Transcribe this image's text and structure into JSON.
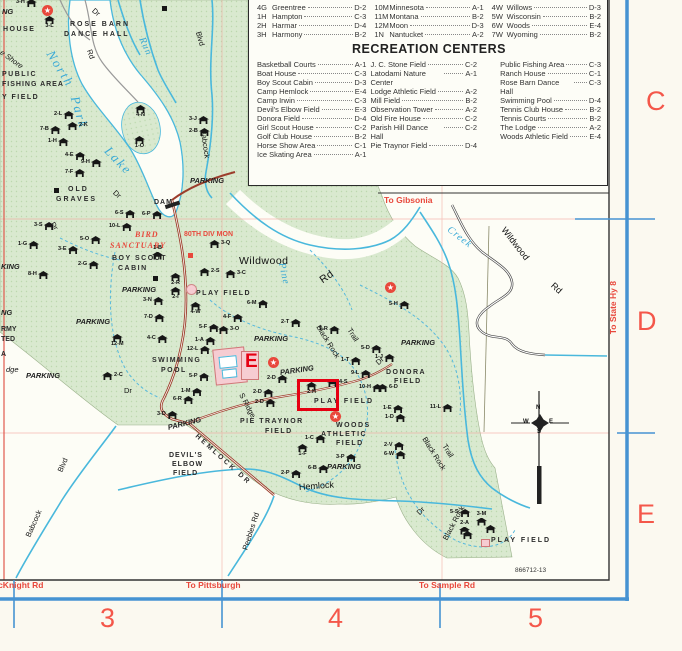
{
  "colors": {
    "park_green": "#d9e9cf",
    "water_blue": "#49b8dc",
    "map_red": "#e8483c",
    "neatline_blue": "#4693d2",
    "road_red": "#9c3d2c",
    "highlight_red": "#e60012"
  },
  "legend_index": {
    "columns": [
      {
        "entries": [
          {
            "code": "4G",
            "name": "Greentree",
            "grid": "D-2"
          },
          {
            "code": "1H",
            "name": "Hampton",
            "grid": "C-3"
          },
          {
            "code": "2H",
            "name": "Harmar",
            "grid": "D-4"
          },
          {
            "code": "3H",
            "name": "Harmony",
            "grid": "B-2"
          }
        ]
      },
      {
        "entries": [
          {
            "code": "10M",
            "name": "Minnesota",
            "grid": "A-1"
          },
          {
            "code": "11M",
            "name": "Montana",
            "grid": "B-2"
          },
          {
            "code": "12M",
            "name": "Moon",
            "grid": "D-3"
          },
          {
            "code": "1N",
            "name": "Nantucket",
            "grid": "A-2"
          }
        ]
      },
      {
        "entries": [
          {
            "code": "4W",
            "name": "Willows",
            "grid": "D-3"
          },
          {
            "code": "5W",
            "name": "Wisconsin",
            "grid": "B-2"
          },
          {
            "code": "6W",
            "name": "Woods",
            "grid": "E-4"
          },
          {
            "code": "7W",
            "name": "Wyoming",
            "grid": "B-2"
          }
        ]
      }
    ]
  },
  "recreation": {
    "title": "RECREATION CENTERS",
    "columns": [
      {
        "entries": [
          {
            "name": "Basketball Courts",
            "grid": "A-1"
          },
          {
            "name": "Boat House",
            "grid": "C-3"
          },
          {
            "name": "Boy Scout Cabin",
            "grid": "D-3"
          },
          {
            "name": "Camp Hemlock",
            "grid": "E-4"
          },
          {
            "name": "Camp Irwin",
            "grid": "C-3"
          },
          {
            "name": "Devil's Elbow Field",
            "grid": "E-3"
          },
          {
            "name": "Donora Field",
            "grid": "D-4"
          },
          {
            "name": "Girl Scout House",
            "grid": "C-2"
          },
          {
            "name": "Golf Club House",
            "grid": "B-2"
          },
          {
            "name": "Horse Show Area",
            "grid": "C-1"
          },
          {
            "name": "Ice Skating Area",
            "grid": "A-1"
          }
        ]
      },
      {
        "entries": [
          {
            "name": "J. C. Stone Field",
            "grid": "C-2"
          },
          {
            "name": "Latodami Nature Center",
            "grid": "A-1"
          },
          {
            "name": "Lodge Athletic Field",
            "grid": "A-2"
          },
          {
            "name": "Mill Field",
            "grid": "B-2"
          },
          {
            "name": "Observation Tower",
            "grid": "A-2"
          },
          {
            "name": "Old Fire House",
            "grid": "C-2"
          },
          {
            "name": "Parish Hill Dance Hall",
            "grid": "C-2"
          },
          {
            "name": "Pie Traynor Field",
            "grid": "D-4"
          }
        ]
      },
      {
        "entries": [
          {
            "name": "Public Fishing Area",
            "grid": "C-3"
          },
          {
            "name": "Ranch House",
            "grid": "C-1"
          },
          {
            "name": "Rose Barn Dance Hall",
            "grid": "C-3"
          },
          {
            "name": "Swimming Pool",
            "grid": "D-4"
          },
          {
            "name": "Tennis Club House",
            "grid": "B-2"
          },
          {
            "name": "Tennis Courts",
            "grid": "B-2"
          },
          {
            "name": "The Lodge",
            "grid": "A-2"
          },
          {
            "name": "Woods Athletic Field",
            "grid": "E-4"
          }
        ]
      }
    ]
  },
  "grid_letters": [
    {
      "t": "C",
      "x": 646,
      "y": 88
    },
    {
      "t": "D",
      "x": 637,
      "y": 308
    },
    {
      "t": "E",
      "x": 637,
      "y": 501
    }
  ],
  "grid_numbers": [
    {
      "t": "3",
      "x": 100,
      "y": 605
    },
    {
      "t": "4",
      "x": 328,
      "y": 605
    },
    {
      "t": "5",
      "x": 528,
      "y": 605
    }
  ],
  "map_number": "866712-13",
  "marker_e": {
    "t": "E",
    "x": 245,
    "y": 352
  },
  "compass": {
    "n": "N",
    "w": "W",
    "e": "E",
    "s": "S"
  },
  "highlight": {
    "x": 297,
    "y": 379,
    "w": 36,
    "h": 26
  },
  "labels": [
    {
      "t": "NG",
      "x": 2,
      "y": 8,
      "c": "pk"
    },
    {
      "t": "HOUSE",
      "x": 3,
      "y": 26,
      "c": "f",
      "ls": 1.5
    },
    {
      "t": "ROSE BARN",
      "x": 70,
      "y": 21,
      "c": "f",
      "ls": 2
    },
    {
      "t": "DANCE HALL",
      "x": 64,
      "y": 31,
      "c": "f",
      "ls": 2
    },
    {
      "t": "Dr",
      "x": 93,
      "y": 6,
      "c": "rd",
      "r": 40
    },
    {
      "t": "Rd",
      "x": 89,
      "y": 46,
      "c": "rd",
      "r": 70
    },
    {
      "t": "North",
      "x": 50,
      "y": 45,
      "c": "wtr",
      "r": 58
    },
    {
      "t": "Park",
      "x": 75,
      "y": 90,
      "c": "wtr",
      "r": 74
    },
    {
      "t": "Lake",
      "x": 107,
      "y": 142,
      "c": "wtr",
      "r": 46
    },
    {
      "t": "Run",
      "x": 141,
      "y": 33,
      "c": "wtrm",
      "r": 66
    },
    {
      "t": "Blvd",
      "x": 198,
      "y": 28,
      "c": "rd",
      "r": 74
    },
    {
      "t": "Babcock",
      "x": 203,
      "y": 126,
      "c": "rd",
      "r": 82
    },
    {
      "t": "e Shore",
      "x": 1,
      "y": 48,
      "c": "rdi",
      "r": 36
    },
    {
      "t": "PUBLIC",
      "x": 2,
      "y": 71,
      "c": "f",
      "ls": 1.5
    },
    {
      "t": "FISHING AREA",
      "x": 2,
      "y": 81,
      "c": "f",
      "ls": 1
    },
    {
      "t": "Y FIELD",
      "x": 2,
      "y": 94,
      "c": "f",
      "ls": 1.5
    },
    {
      "t": "OLD",
      "x": 68,
      "y": 186,
      "c": "f",
      "ls": 2
    },
    {
      "t": "GRAVES",
      "x": 56,
      "y": 196,
      "c": "f",
      "ls": 2
    },
    {
      "t": "DAM",
      "x": 154,
      "y": 199,
      "c": "f",
      "ls": 1
    },
    {
      "t": "PARKING",
      "x": 190,
      "y": 177,
      "c": "pk"
    },
    {
      "t": "Dr",
      "x": 114,
      "y": 188,
      "c": "rd",
      "r": 42
    },
    {
      "t": "Dr",
      "x": 52,
      "y": 219,
      "c": "rd",
      "r": 58
    },
    {
      "t": "BIRD",
      "x": 135,
      "y": 231,
      "c": "redit"
    },
    {
      "t": "SANCTUARY",
      "x": 110,
      "y": 242,
      "c": "redit"
    },
    {
      "t": "80TH DIV MON",
      "x": 184,
      "y": 231,
      "c": "redsm"
    },
    {
      "t": "BOY SCOUT",
      "x": 112,
      "y": 255,
      "c": "f",
      "ls": 1.5
    },
    {
      "t": "CABIN",
      "x": 118,
      "y": 265,
      "c": "f",
      "ls": 1.5
    },
    {
      "t": "PARKING",
      "x": 122,
      "y": 286,
      "c": "pk"
    },
    {
      "t": "KING",
      "x": 1,
      "y": 263,
      "c": "pk"
    },
    {
      "t": "PLAY FIELD",
      "x": 196,
      "y": 290,
      "c": "f",
      "ls": 1.5
    },
    {
      "t": "PARKING",
      "x": 76,
      "y": 318,
      "c": "pk"
    },
    {
      "t": "NG",
      "x": 1,
      "y": 309,
      "c": "pk"
    },
    {
      "t": "RMY",
      "x": 1,
      "y": 326,
      "c": "f"
    },
    {
      "t": "TED",
      "x": 1,
      "y": 336,
      "c": "f"
    },
    {
      "t": "A",
      "x": 1,
      "y": 351,
      "c": "f"
    },
    {
      "t": "dge",
      "x": 6,
      "y": 366,
      "c": "rdi"
    },
    {
      "t": "PARKING",
      "x": 26,
      "y": 372,
      "c": "pk"
    },
    {
      "t": "Dr",
      "x": 124,
      "y": 387,
      "c": "rd"
    },
    {
      "t": "Wildwood",
      "x": 239,
      "y": 256,
      "c": "big"
    },
    {
      "t": "Rd",
      "x": 321,
      "y": 276,
      "c": "big",
      "r": -35
    },
    {
      "t": "Pine",
      "x": 281,
      "y": 258,
      "c": "wtrm",
      "r": 78
    },
    {
      "t": "To Gibsonia",
      "x": 384,
      "y": 196,
      "c": "red"
    },
    {
      "t": "Creek",
      "x": 448,
      "y": 224,
      "c": "wtrm",
      "r": 38
    },
    {
      "t": "Wildwood",
      "x": 503,
      "y": 224,
      "c": "rd2",
      "r": 52
    },
    {
      "t": "Rd",
      "x": 552,
      "y": 280,
      "c": "rd2",
      "r": 42
    },
    {
      "t": "To State Hy 8",
      "x": 613,
      "y": 330,
      "c": "red",
      "r": -90
    },
    {
      "t": "SWIMMING",
      "x": 152,
      "y": 357,
      "c": "f",
      "ls": 1.5
    },
    {
      "t": "POOL",
      "x": 161,
      "y": 367,
      "c": "f",
      "ls": 1.5
    },
    {
      "t": "PARKING",
      "x": 254,
      "y": 335,
      "c": "pk"
    },
    {
      "t": "PARKING",
      "x": 280,
      "y": 369,
      "c": "pk",
      "r": -8
    },
    {
      "t": "PARKING",
      "x": 401,
      "y": 339,
      "c": "pk"
    },
    {
      "t": "Black Rock",
      "x": 318,
      "y": 322,
      "c": "rd",
      "r": 58
    },
    {
      "t": "Trail",
      "x": 349,
      "y": 325,
      "c": "rd",
      "r": 58
    },
    {
      "t": "Dr",
      "x": 377,
      "y": 360,
      "c": "rd",
      "r": -42
    },
    {
      "t": "DONORA",
      "x": 386,
      "y": 369,
      "c": "f",
      "ls": 1.5
    },
    {
      "t": "FIELD",
      "x": 394,
      "y": 378,
      "c": "f",
      "ls": 1.5
    },
    {
      "t": "S Ridge",
      "x": 241,
      "y": 390,
      "c": "rd",
      "r": 62
    },
    {
      "t": "PLAY FIELD",
      "x": 314,
      "y": 398,
      "c": "f",
      "ls": 2
    },
    {
      "t": "PIE TRAYNOR",
      "x": 240,
      "y": 418,
      "c": "f",
      "ls": 1.5
    },
    {
      "t": "FIELD",
      "x": 265,
      "y": 428,
      "c": "f",
      "ls": 1.5
    },
    {
      "t": "WOODS",
      "x": 336,
      "y": 422,
      "c": "f",
      "ls": 1.5
    },
    {
      "t": "ATHLETIC",
      "x": 321,
      "y": 431,
      "c": "f",
      "ls": 1.5
    },
    {
      "t": "FIELD",
      "x": 336,
      "y": 440,
      "c": "f",
      "ls": 1.5
    },
    {
      "t": "PARKING",
      "x": 168,
      "y": 424,
      "c": "pk",
      "r": -14
    },
    {
      "t": "DEVIL'S",
      "x": 169,
      "y": 452,
      "c": "f",
      "ls": 1
    },
    {
      "t": "ELBOW",
      "x": 172,
      "y": 461,
      "c": "f",
      "ls": 1
    },
    {
      "t": "FIELD",
      "x": 173,
      "y": 470,
      "c": "f",
      "ls": 1
    },
    {
      "t": "HEMLOCK DR",
      "x": 196,
      "y": 432,
      "c": "f",
      "ls": 2.5,
      "r": 42
    },
    {
      "t": "Hemlock",
      "x": 299,
      "y": 483,
      "c": "rd2",
      "r": -4
    },
    {
      "t": "PARKING",
      "x": 327,
      "y": 463,
      "c": "pk"
    },
    {
      "t": "Black Rock",
      "x": 424,
      "y": 434,
      "c": "rd",
      "r": 58
    },
    {
      "t": "Trail",
      "x": 444,
      "y": 441,
      "c": "rd",
      "r": 58
    },
    {
      "t": "Black Rock",
      "x": 445,
      "y": 536,
      "c": "rd",
      "r": -62
    },
    {
      "t": "Babcock",
      "x": 28,
      "y": 533,
      "c": "rd",
      "r": -66
    },
    {
      "t": "Blvd",
      "x": 60,
      "y": 468,
      "c": "rd",
      "r": -66
    },
    {
      "t": "Peebles Rd",
      "x": 245,
      "y": 546,
      "c": "rd",
      "r": -72
    },
    {
      "t": "Dr",
      "x": 418,
      "y": 510,
      "c": "rd",
      "r": -45
    },
    {
      "t": "PLAY FIELD",
      "x": 491,
      "y": 537,
      "c": "f",
      "ls": 2
    },
    {
      "t": "866712-13",
      "x": 515,
      "y": 568,
      "c": "tiny"
    },
    {
      "t": "McKnight Rd",
      "x": -9,
      "y": 581,
      "c": "red"
    },
    {
      "t": "To Pittsburgh",
      "x": 186,
      "y": 581,
      "c": "red"
    },
    {
      "t": "To Sample Rd",
      "x": 419,
      "y": 581,
      "c": "red"
    }
  ],
  "shelters": [
    {
      "c": "3-H",
      "x": 22,
      "y": 3,
      "lp": "l"
    },
    {
      "c": "3-L",
      "x": 50,
      "y": 20,
      "lp": "b"
    },
    {
      "c": "2-L",
      "x": 60,
      "y": 115,
      "lp": "l"
    },
    {
      "c": "2-K",
      "x": 73,
      "y": 126,
      "lp": "r"
    },
    {
      "c": "7-B",
      "x": 46,
      "y": 130,
      "lp": "l"
    },
    {
      "c": "1-H",
      "x": 54,
      "y": 142,
      "lp": "l"
    },
    {
      "c": "4-E",
      "x": 71,
      "y": 156,
      "lp": "l"
    },
    {
      "c": "9-H",
      "x": 87,
      "y": 163,
      "lp": "l"
    },
    {
      "c": "7-F",
      "x": 71,
      "y": 173,
      "lp": "l"
    },
    {
      "c": "4-N",
      "x": 141,
      "y": 109,
      "lp": "b"
    },
    {
      "c": "1-O",
      "x": 140,
      "y": 140,
      "lp": "b"
    },
    {
      "c": "3-J",
      "x": 195,
      "y": 120,
      "lp": "l"
    },
    {
      "c": "2-B",
      "x": 195,
      "y": 132,
      "lp": "l"
    },
    {
      "c": "3-S",
      "x": 40,
      "y": 226,
      "lp": "l"
    },
    {
      "c": "6-S",
      "x": 121,
      "y": 214,
      "lp": "l"
    },
    {
      "c": "6-P",
      "x": 148,
      "y": 215,
      "lp": "l"
    },
    {
      "c": "10-L",
      "x": 115,
      "y": 227,
      "lp": "l"
    },
    {
      "c": "1-G",
      "x": 24,
      "y": 245,
      "lp": "l"
    },
    {
      "c": "5-O",
      "x": 86,
      "y": 240,
      "lp": "l"
    },
    {
      "c": "3-E",
      "x": 64,
      "y": 250,
      "lp": "l"
    },
    {
      "c": "2-G",
      "x": 84,
      "y": 265,
      "lp": "l"
    },
    {
      "c": "8-H",
      "x": 34,
      "y": 275,
      "lp": "l"
    },
    {
      "c": "1-B",
      "x": 158,
      "y": 250,
      "lp": "t"
    },
    {
      "c": "2-R",
      "x": 176,
      "y": 277,
      "lp": "b"
    },
    {
      "c": "2-I",
      "x": 176,
      "y": 291,
      "lp": "b"
    },
    {
      "c": "3-N",
      "x": 149,
      "y": 301,
      "lp": "l"
    },
    {
      "c": "2-S",
      "x": 205,
      "y": 272,
      "lp": "r"
    },
    {
      "c": "3-Q",
      "x": 215,
      "y": 244,
      "lp": "r"
    },
    {
      "c": "3-C",
      "x": 231,
      "y": 274,
      "lp": "r"
    },
    {
      "c": "4-W",
      "x": 196,
      "y": 306,
      "lp": "b"
    },
    {
      "c": "7-D",
      "x": 150,
      "y": 318,
      "lp": "l"
    },
    {
      "c": "12-M",
      "x": 117,
      "y": 338,
      "lp": "b"
    },
    {
      "c": "4-C",
      "x": 153,
      "y": 339,
      "lp": "l"
    },
    {
      "c": "5-F",
      "x": 205,
      "y": 328,
      "lp": "l"
    },
    {
      "c": "1-A",
      "x": 201,
      "y": 341,
      "lp": "l"
    },
    {
      "c": "3-O",
      "x": 224,
      "y": 330,
      "lp": "r"
    },
    {
      "c": "2-C",
      "x": 108,
      "y": 376,
      "lp": "r"
    },
    {
      "c": "12-L",
      "x": 193,
      "y": 350,
      "lp": "l"
    },
    {
      "c": "5-P",
      "x": 195,
      "y": 377,
      "lp": "l"
    },
    {
      "c": "1-M",
      "x": 187,
      "y": 392,
      "lp": "l"
    },
    {
      "c": "6-R",
      "x": 179,
      "y": 400,
      "lp": "l"
    },
    {
      "c": "3-D",
      "x": 163,
      "y": 415,
      "lp": "l"
    },
    {
      "c": "6-M",
      "x": 253,
      "y": 304,
      "lp": "l"
    },
    {
      "c": "4-F",
      "x": 229,
      "y": 318,
      "lp": "l"
    },
    {
      "c": "2-T",
      "x": 287,
      "y": 323,
      "lp": "l"
    },
    {
      "c": "1-R",
      "x": 325,
      "y": 330,
      "lp": "l"
    },
    {
      "c": "5-H",
      "x": 395,
      "y": 305,
      "lp": "l"
    },
    {
      "c": "5-D",
      "x": 367,
      "y": 349,
      "lp": "l"
    },
    {
      "c": "1-T",
      "x": 347,
      "y": 361,
      "lp": "l"
    },
    {
      "c": "9-L",
      "x": 357,
      "y": 374,
      "lp": "l"
    },
    {
      "c": "4-S",
      "x": 333,
      "y": 383,
      "lp": "r"
    },
    {
      "c": "2-H",
      "x": 312,
      "y": 386,
      "lp": "b"
    },
    {
      "c": "10-H",
      "x": 365,
      "y": 388,
      "lp": "l"
    },
    {
      "c": "6-D",
      "x": 383,
      "y": 388,
      "lp": "r"
    },
    {
      "c": "1-J",
      "x": 381,
      "y": 358,
      "lp": "l"
    },
    {
      "c": "2-D",
      "x": 273,
      "y": 379,
      "lp": "l"
    },
    {
      "c": "2-D",
      "x": 259,
      "y": 393,
      "lp": "l"
    },
    {
      "c": "2-D",
      "x": 261,
      "y": 403,
      "lp": "l"
    },
    {
      "c": "1-E",
      "x": 389,
      "y": 409,
      "lp": "l"
    },
    {
      "c": "11-L",
      "x": 436,
      "y": 408,
      "lp": "l"
    },
    {
      "c": "1-D",
      "x": 391,
      "y": 418,
      "lp": "l"
    },
    {
      "c": "1-C",
      "x": 311,
      "y": 439,
      "lp": "l"
    },
    {
      "c": "1-F",
      "x": 303,
      "y": 448,
      "lp": "b"
    },
    {
      "c": "2-V",
      "x": 390,
      "y": 446,
      "lp": "l"
    },
    {
      "c": "6-W",
      "x": 390,
      "y": 455,
      "lp": "l"
    },
    {
      "c": "3-P",
      "x": 342,
      "y": 458,
      "lp": "l"
    },
    {
      "c": "6-B",
      "x": 314,
      "y": 469,
      "lp": "l"
    },
    {
      "c": "2-P",
      "x": 287,
      "y": 474,
      "lp": "l"
    },
    {
      "c": "5-S",
      "x": 456,
      "y": 513,
      "lp": "l"
    },
    {
      "c": "3-M",
      "x": 482,
      "y": 516,
      "lp": "t"
    },
    {
      "c": "2-A",
      "x": 465,
      "y": 525,
      "lp": "t"
    },
    {
      "c": "",
      "x": 491,
      "y": 529,
      "lp": "r"
    },
    {
      "c": "",
      "x": 468,
      "y": 535,
      "lp": "r"
    }
  ],
  "stars": [
    {
      "x": 47,
      "y": 10
    },
    {
      "x": 273,
      "y": 362
    },
    {
      "x": 335,
      "y": 416
    },
    {
      "x": 390,
      "y": 287
    }
  ],
  "squares_black": [
    {
      "x": 162,
      "y": 6
    },
    {
      "x": 54,
      "y": 188
    },
    {
      "x": 153,
      "y": 276
    }
  ],
  "squares_red": [
    {
      "x": 188,
      "y": 253
    }
  ],
  "squares_pink": [
    {
      "x": 481,
      "y": 539
    }
  ],
  "circles_pink": [
    {
      "x": 186,
      "y": 284
    }
  ]
}
